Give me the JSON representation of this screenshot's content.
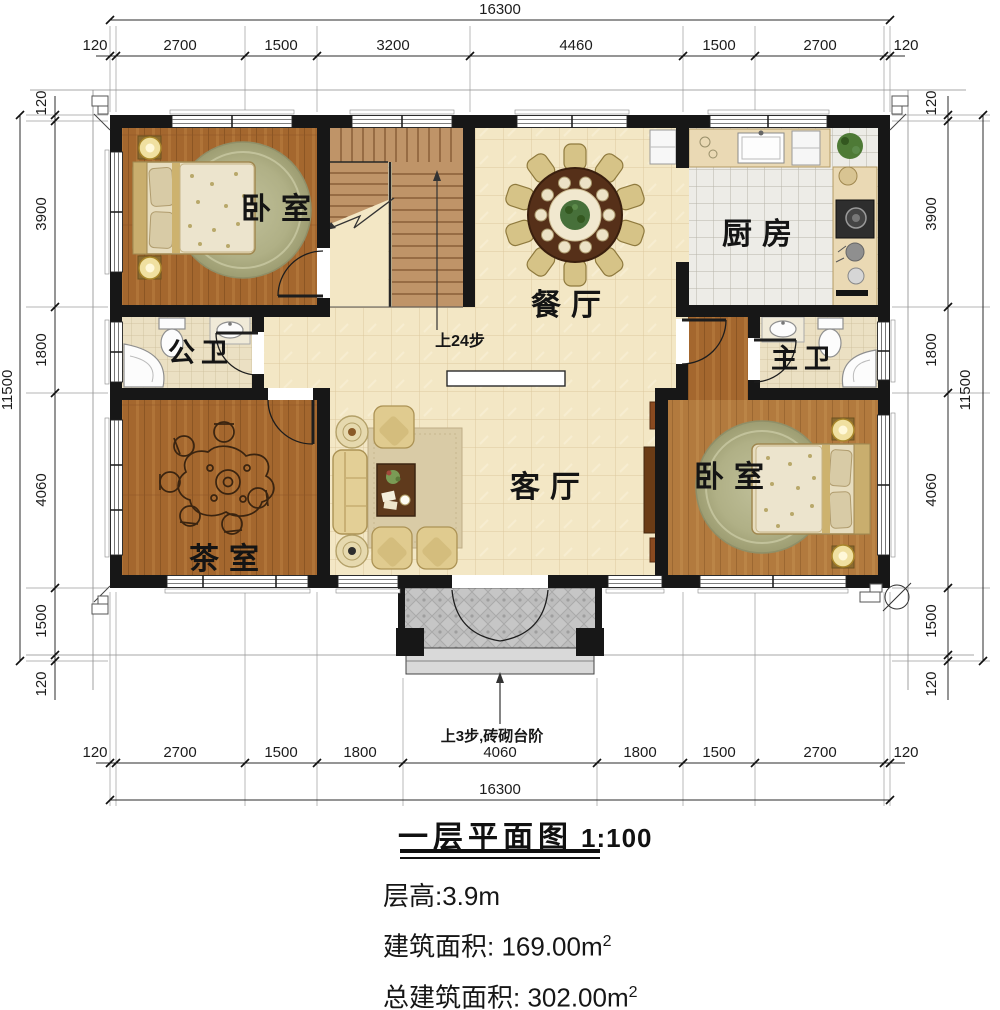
{
  "title": {
    "text": "一层平面图",
    "scale": "1:100"
  },
  "specs": {
    "height": "层高:3.9m",
    "area_label": "建筑面积:",
    "area_value": " 169.00m",
    "area_sup": "2",
    "total_label": "总建筑面积:",
    "total_value": " 302.00m",
    "total_sup": "2"
  },
  "rooms": {
    "bedroom_left": "卧室",
    "bedroom_right": "卧室",
    "kitchen": "厨房",
    "dining": "餐厅",
    "living": "客厅",
    "tea": "茶室",
    "public_bath": "公卫",
    "master_bath": "主卫"
  },
  "annotations": {
    "stair_note": "上24步",
    "entry_note": "上3步,砖砌台阶"
  },
  "dimensions": {
    "top": {
      "total": "16300",
      "segments": [
        "120",
        "2700",
        "1500",
        "3200",
        "4460",
        "1500",
        "2700",
        "120"
      ]
    },
    "bottom": {
      "total": "16300",
      "segments": [
        "120",
        "2700",
        "1500",
        "1800",
        "4060",
        "1800",
        "1500",
        "2700",
        "120"
      ]
    },
    "left": {
      "total": "11500",
      "segments": [
        "120",
        "3900",
        "1800",
        "4060",
        "1500",
        "120"
      ]
    },
    "right": {
      "total": "11500",
      "segments": [
        "120",
        "3900",
        "1800",
        "4060",
        "1500",
        "120"
      ]
    }
  },
  "colors": {
    "wall": "#171717",
    "wood_floor": "#a4672e",
    "wood_floor_light": "#b27a3e",
    "tile_cream": "#f3e7c5",
    "tile_white": "#edece7",
    "tile_bath": "#ebe0c3",
    "porch_gray": "#c4c4c4",
    "sofa_gold": "#e0cb8f",
    "table_brown": "#563019",
    "rug_sage": "#b0b086"
  }
}
